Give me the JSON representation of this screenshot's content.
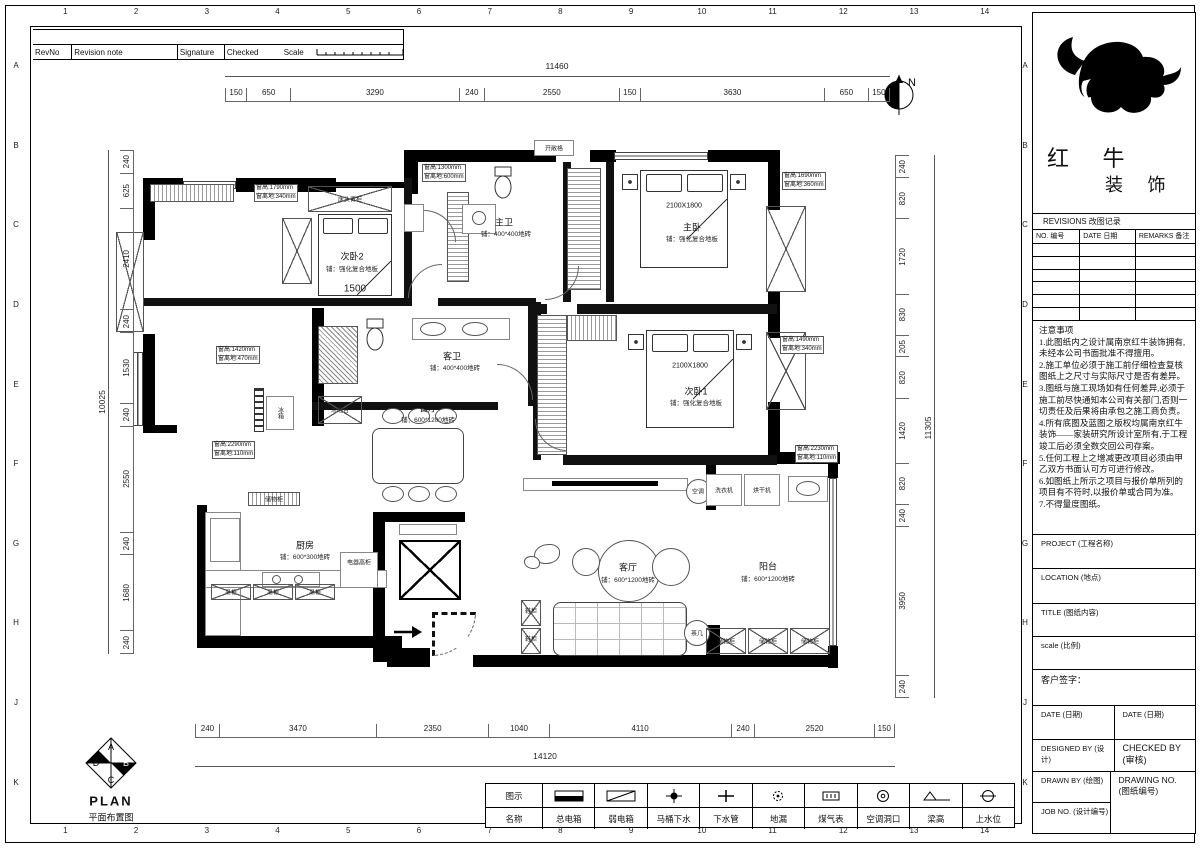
{
  "sheet": {
    "numbers": [
      "1",
      "2",
      "3",
      "4",
      "5",
      "6",
      "7",
      "8",
      "9",
      "10",
      "11",
      "12",
      "13",
      "14"
    ],
    "letters": [
      "A",
      "B",
      "C",
      "D",
      "E",
      "F",
      "G",
      "H",
      "J",
      "K"
    ]
  },
  "revision_strip": {
    "rev_no": "RevNo",
    "revision_note": "Revision note",
    "signature": "Signature",
    "checked": "Checked",
    "scale": "Scale"
  },
  "north": {
    "label": "N"
  },
  "stamp": {
    "a": "A",
    "b": "B",
    "c": "C",
    "d": "D",
    "title_en": "PLAN",
    "title_cn": "平面布置图"
  },
  "plan": {
    "rooms": {
      "bedroom2": {
        "name": "次卧2",
        "floor": "铺：强化复合地板"
      },
      "master_bath": {
        "name": "主卫",
        "floor": "铺：400*400地砖"
      },
      "master_bedroom": {
        "name": "主卧",
        "floor": "铺：强化复合地板"
      },
      "bedroom1": {
        "name": "次卧1",
        "floor": "铺：强化复合地板"
      },
      "guest_bath": {
        "name": "客卫",
        "floor": "铺：400*400地砖"
      },
      "dining": {
        "name": "餐厅",
        "floor": "铺：600*1200地砖"
      },
      "kitchen": {
        "name": "厨房",
        "floor": "铺：600*300地砖"
      },
      "living": {
        "name": "客厅",
        "floor": "铺：600*1200地砖"
      },
      "balcony": {
        "name": "阳台",
        "floor": "铺：600*1200地砖"
      }
    },
    "labels": {
      "headboard_cabinet": "床头背柜",
      "open_shelf": "开敞格",
      "bar_counter": "木吧台",
      "fridge": "冰箱",
      "storage_cabinet": "储物柜",
      "appliance_cabinet": "电器高柜",
      "hanging_cabinet": "吊柜",
      "shoe_cabinet": "鞋柜",
      "tea_table": "茶几",
      "air_conditioner": "空调",
      "washer": "洗衣机",
      "dryer": "烘干机",
      "bed_size": "2100X1800",
      "inner_dim": "1500"
    },
    "callouts": {
      "c1": {
        "l1": "窗高:1790mm",
        "l2": "窗离地:340mm"
      },
      "c2": {
        "l1": "窗高:1300mm",
        "l2": "窗离地:600mm"
      },
      "c3": {
        "l1": "窗高:1690mm",
        "l2": "窗离地:360mm"
      },
      "c4": {
        "l1": "窗高:1490mm",
        "l2": "窗离地:340mm"
      },
      "c5": {
        "l1": "窗高:1420mm",
        "l2": "窗离地:470mm"
      },
      "c6": {
        "l1": "窗高:2290mm",
        "l2": "窗离地:110mm"
      },
      "c7": {
        "l1": "窗高:2230mm",
        "l2": "窗离地:110mm"
      }
    }
  },
  "dims": {
    "top": {
      "overall": "11460",
      "segments": [
        "150",
        "650",
        "3290",
        "240",
        "2550",
        "150",
        "3630",
        "650",
        "150"
      ]
    },
    "bottom": {
      "overall": "14120",
      "segments": [
        "240",
        "3470",
        "2350",
        "1040",
        "4110",
        "240",
        "2520",
        "150"
      ]
    },
    "left": {
      "overall": "10025",
      "segments": [
        "240",
        "625",
        "2410",
        "240",
        "1530",
        "240",
        "2550",
        "240",
        "1680",
        "240"
      ]
    },
    "right": {
      "overall": "11305",
      "segments": [
        "240",
        "820",
        "1720",
        "830",
        "205",
        "820",
        "1420",
        "820",
        "240",
        "3950",
        "240"
      ]
    }
  },
  "legend": {
    "symbol_header": "图示",
    "name_header": "名称",
    "items": [
      {
        "name": "总电箱"
      },
      {
        "name": "弱电箱"
      },
      {
        "name": "马桶下水"
      },
      {
        "name": "下水管"
      },
      {
        "name": "地漏"
      },
      {
        "name": "煤气表"
      },
      {
        "name": "空调洞口"
      },
      {
        "name": "梁高"
      },
      {
        "name": "上水位"
      }
    ]
  },
  "title_block": {
    "brand": {
      "cn1": "红 牛",
      "cn2": "装 饰"
    },
    "revisions": {
      "title": "REVISIONS 改图记录",
      "no": "NO. 编号",
      "date": "DATE 日期",
      "remarks": "REMARKS 备注"
    },
    "notes": {
      "title": "注意事项",
      "items": [
        "1.此图纸内之设计属南京红牛装饰拥有,未经本公司书面批准不得擅用。",
        "2.施工单位必须于施工前仔细检查复核图纸上之尺寸与实际尺寸是否有差异。",
        "3.图纸与施工现场如有任何差异,必须于施工前尽快通知本公司有关部门,否则一切责任及后果将由承包之施工商负责。",
        "4.所有底图及蓝图之版权均属南京红牛装饰——家装研究所设计室所有,于工程竣工后必须全数交回公司存案。",
        "5.任何工程上之增减更改项目必须由甲乙双方书面认可方可进行修改。",
        "6.如图纸上所示之项目与报价单所列的项目有不符时,以报价单或合同为准。",
        "7.不得量度图纸。"
      ]
    },
    "fields": {
      "project": "PROJECT (工程名称)",
      "location": "LOCATION (地点)",
      "title": "TITLE (图纸内容)",
      "scale": "scale (比例)",
      "client_sign": "客户签字：",
      "date1": "DATE (日期)",
      "date2": "DATE (日期)",
      "designed": "DESIGNED BY (设计)",
      "checked1": "CHECKED BY",
      "checked2": "(审核)",
      "drawn": "DRAWN BY (绘图)",
      "drawing_no1": "DRAWING NO.",
      "drawing_no2": "(图纸编号)",
      "job": "JOB NO. (设计编号)"
    }
  }
}
